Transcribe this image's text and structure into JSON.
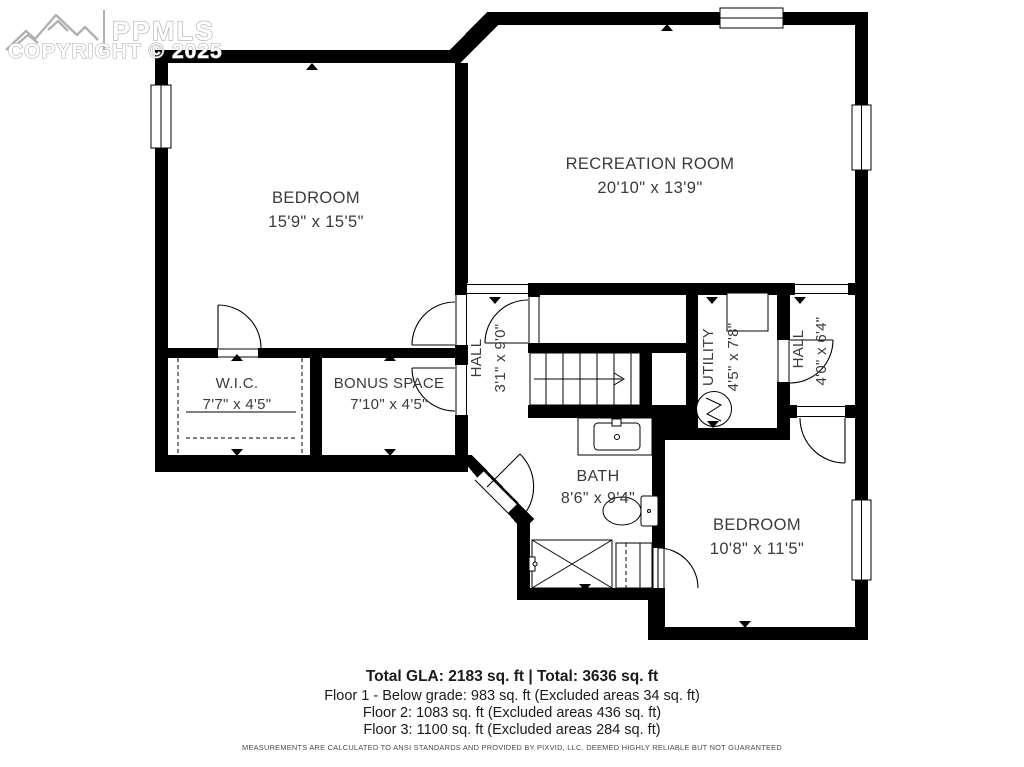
{
  "watermark": {
    "brand": "PPMLS",
    "copyright": "COPYRIGHT © 2025"
  },
  "rooms": {
    "bedroom1": {
      "name": "BEDROOM",
      "dims": "15'9\" x 15'5\""
    },
    "recreation": {
      "name": "RECREATION ROOM",
      "dims": "20'10\" x 13'9\""
    },
    "wic": {
      "name": "W.I.C.",
      "dims": "7'7\" x 4'5\""
    },
    "bonus": {
      "name": "BONUS SPACE",
      "dims": "7'10\" x 4'5\""
    },
    "hall1": {
      "name": "HALL",
      "dims": "3'1\" x 9'0\""
    },
    "utility": {
      "name": "UTILITY",
      "dims": "4'5\" x 7'8\""
    },
    "hall2": {
      "name": "HALL",
      "dims": "4'0\" x 6'4\""
    },
    "bath": {
      "name": "BATH",
      "dims": "8'6\" x 9'4\""
    },
    "bedroom2": {
      "name": "BEDROOM",
      "dims": "10'8\" x 11'5\""
    }
  },
  "summary": {
    "total": "Total GLA: 2183 sq. ft | Total: 3636 sq. ft",
    "floor1": "Floor 1 - Below grade: 983 sq. ft (Excluded areas 34 sq. ft)",
    "floor2": "Floor 2: 1083 sq. ft (Excluded areas 436 sq. ft)",
    "floor3": "Floor 3: 1100 sq. ft (Excluded areas 284 sq. ft)"
  },
  "disclaimer": "MEASUREMENTS ARE CALCULATED TO ANSI STANDARDS AND PROVIDED BY PIXVID, LLC. DEEMED HIGHLY RELIABLE BUT NOT GUARANTEED",
  "colors": {
    "wall": "#000000",
    "label": "#3b3b3b",
    "watermark_stroke": "#ababab"
  }
}
